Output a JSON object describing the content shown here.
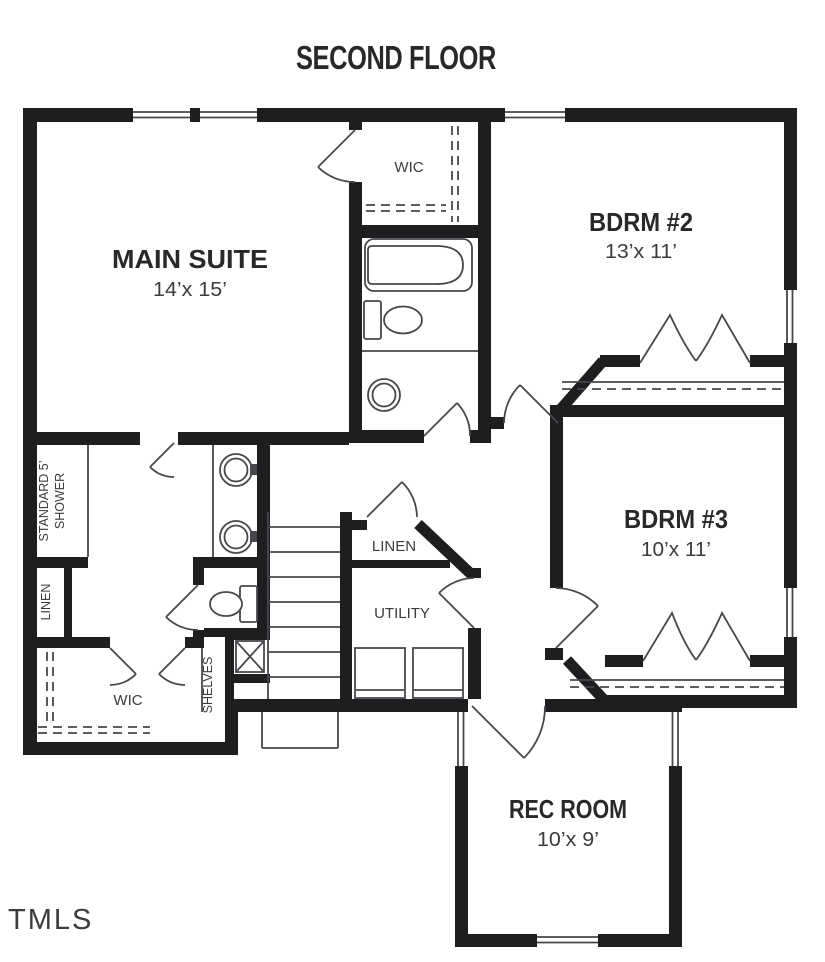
{
  "title": "SECOND FLOOR",
  "watermark": "TMLS",
  "rooms": {
    "main_suite": {
      "name": "MAIN SUITE",
      "dims": "14’x 15’"
    },
    "bdrm2": {
      "name": "BDRM #2",
      "dims": "13’x 11’"
    },
    "bdrm3": {
      "name": "BDRM #3",
      "dims": "10’x 11’"
    },
    "rec_room": {
      "name": "REC ROOM",
      "dims": "10’x 9’"
    },
    "wic_top": {
      "name": "WIC"
    },
    "wic_bottom": {
      "name": "WIC"
    },
    "linen_left": {
      "name": "LINEN"
    },
    "linen_center": {
      "name": "LINEN"
    },
    "utility": {
      "name": "UTILITY"
    },
    "shelves": {
      "name": "SHELVES"
    },
    "shower": {
      "line1": "STANDARD 5’",
      "line2": "SHOWER"
    }
  },
  "colors": {
    "wall": "#1e1e21",
    "line": "#47474c",
    "text": "#28282b",
    "subtext": "#3b3b40",
    "watermark": "#3c3c40",
    "bg": "#ffffff"
  }
}
